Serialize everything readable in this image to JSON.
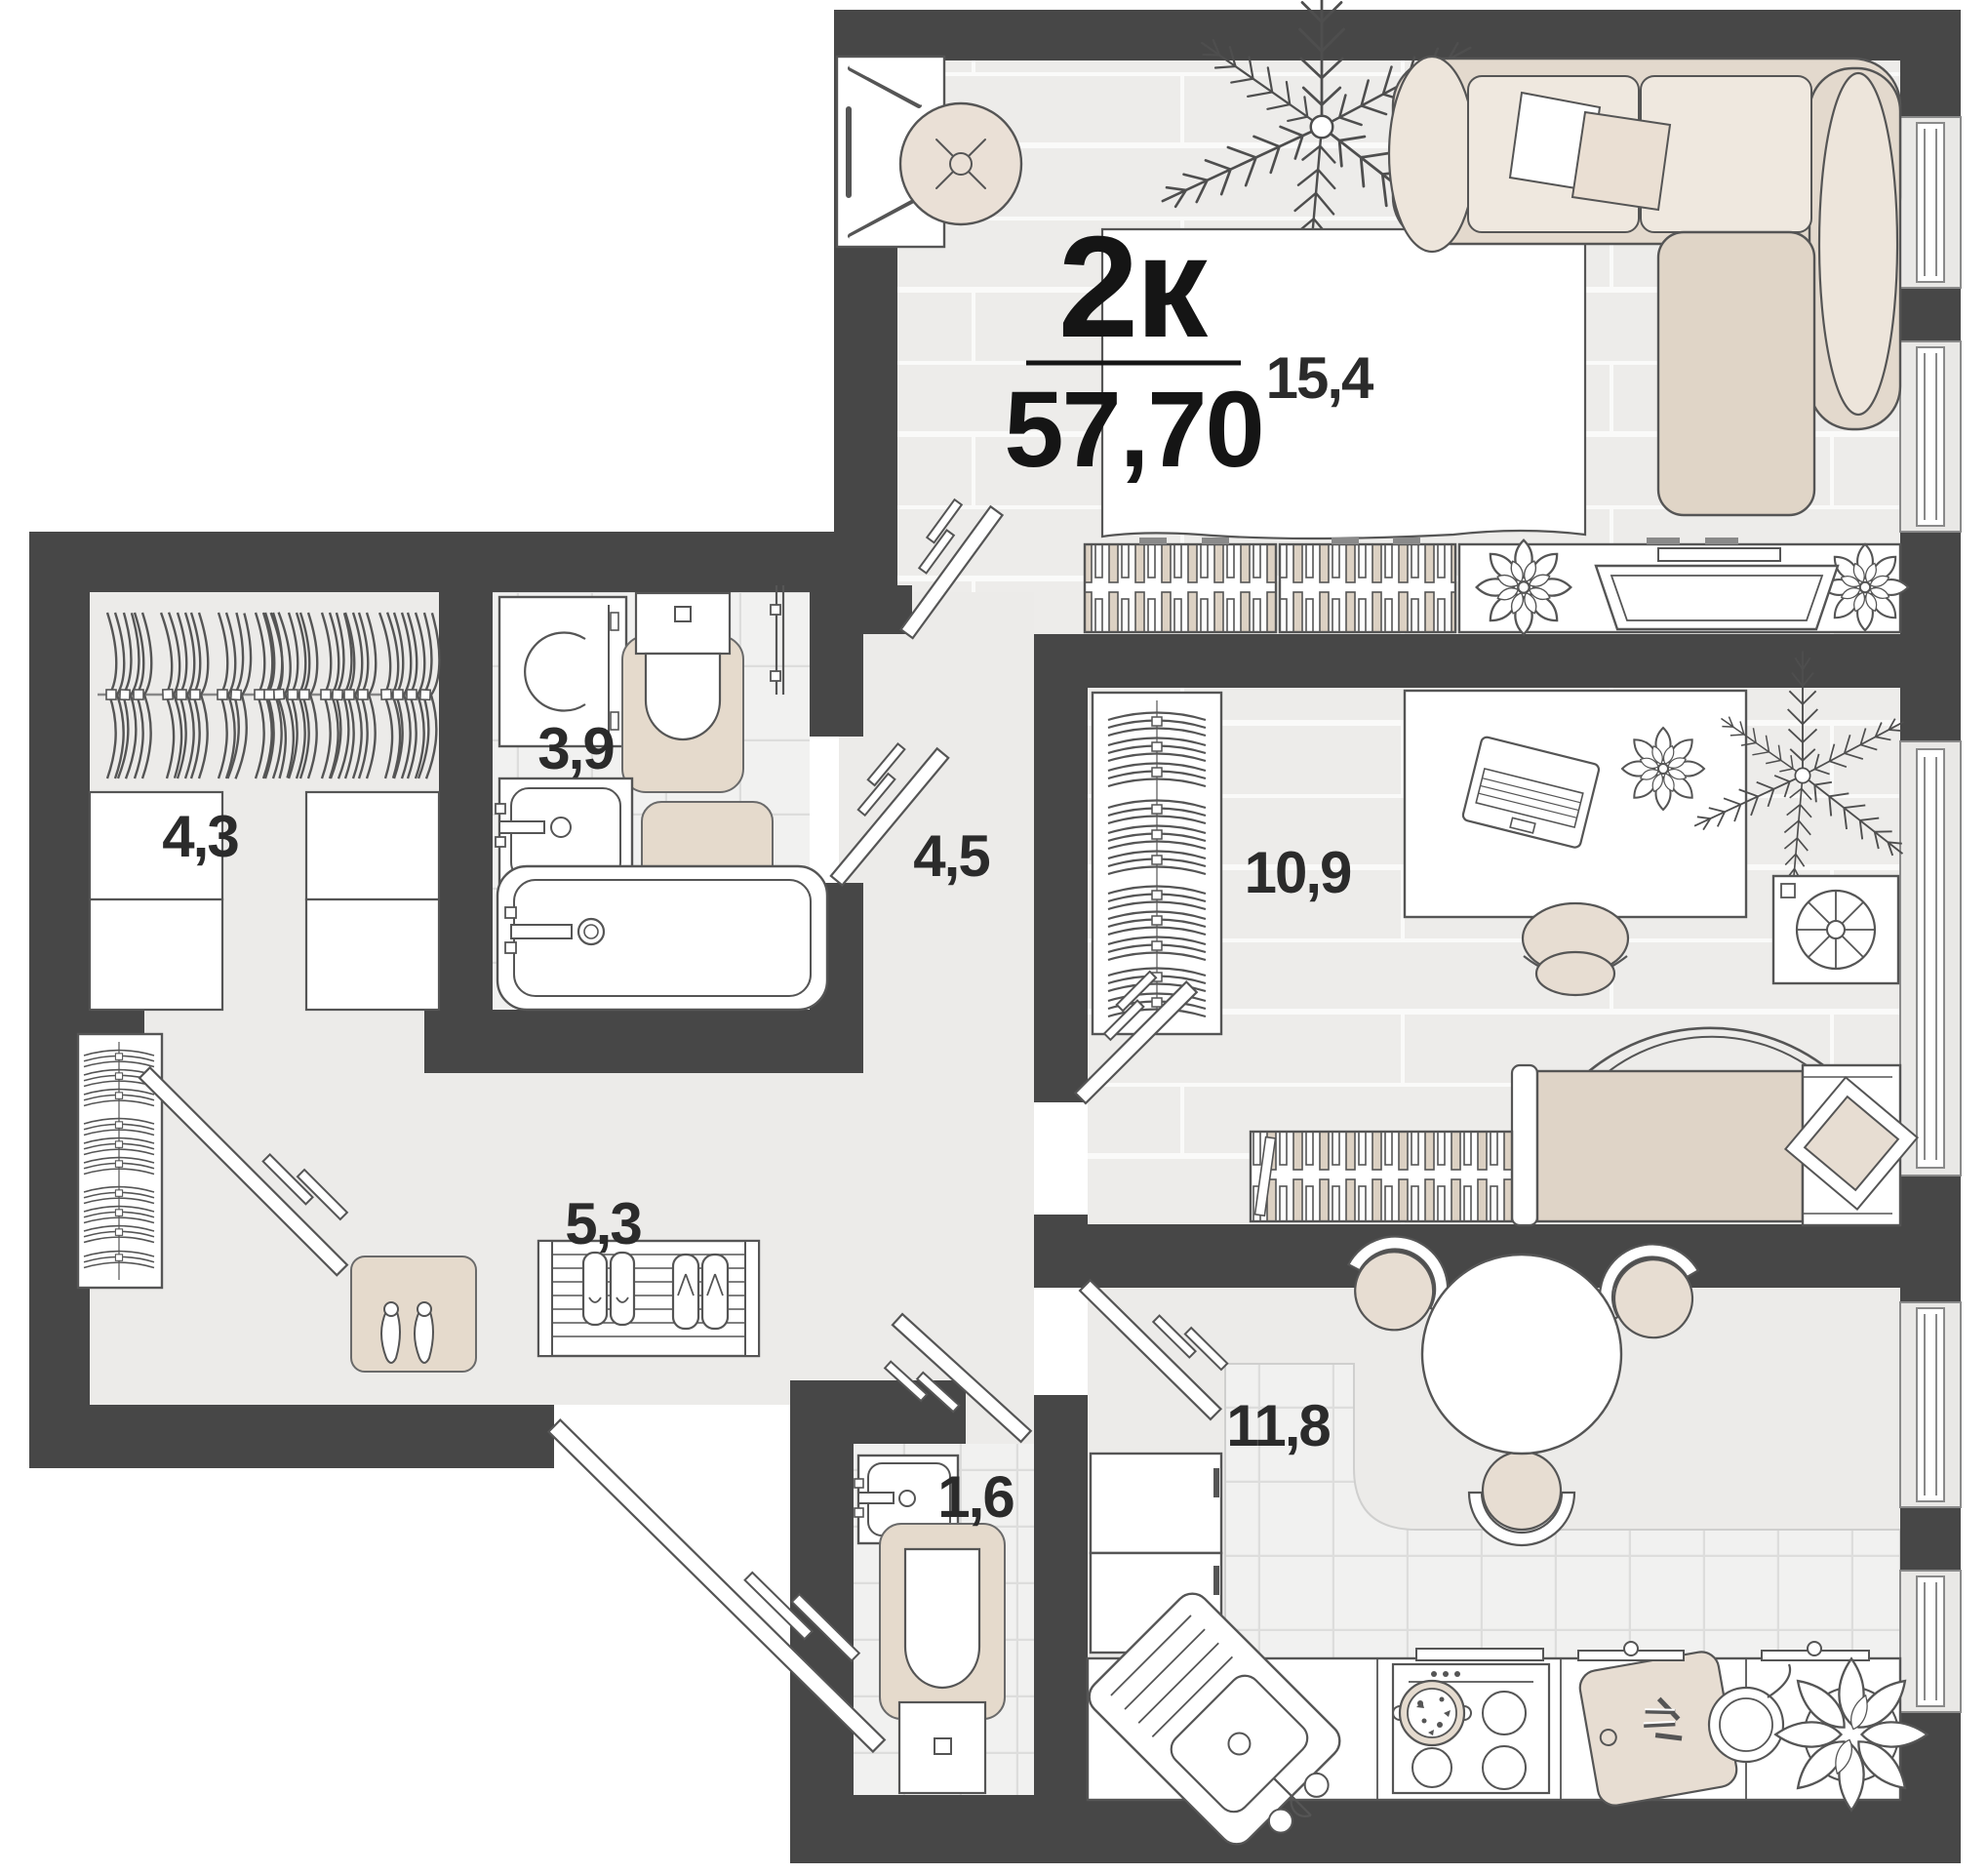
{
  "title": {
    "type_label": "2к",
    "total_area": "57,70"
  },
  "room_areas": {
    "living": "15,4",
    "bedroom": "10,9",
    "kitchen": "11,8",
    "hallway": "5,3",
    "corridor": "4,5",
    "wardrobe_room": "4,3",
    "bathroom": "3,9",
    "wc": "1,6"
  },
  "colors": {
    "wall": "#474747",
    "plank_floor": "#EDECEA",
    "plain_floor": "#ECEBE9",
    "tile_floor": "#F1F1F0",
    "accent_beige": "#E2D7CA",
    "cushion_beige": "#F0EAE2",
    "outline": "#4E4E4E",
    "label_text": "#2b2b2b"
  }
}
